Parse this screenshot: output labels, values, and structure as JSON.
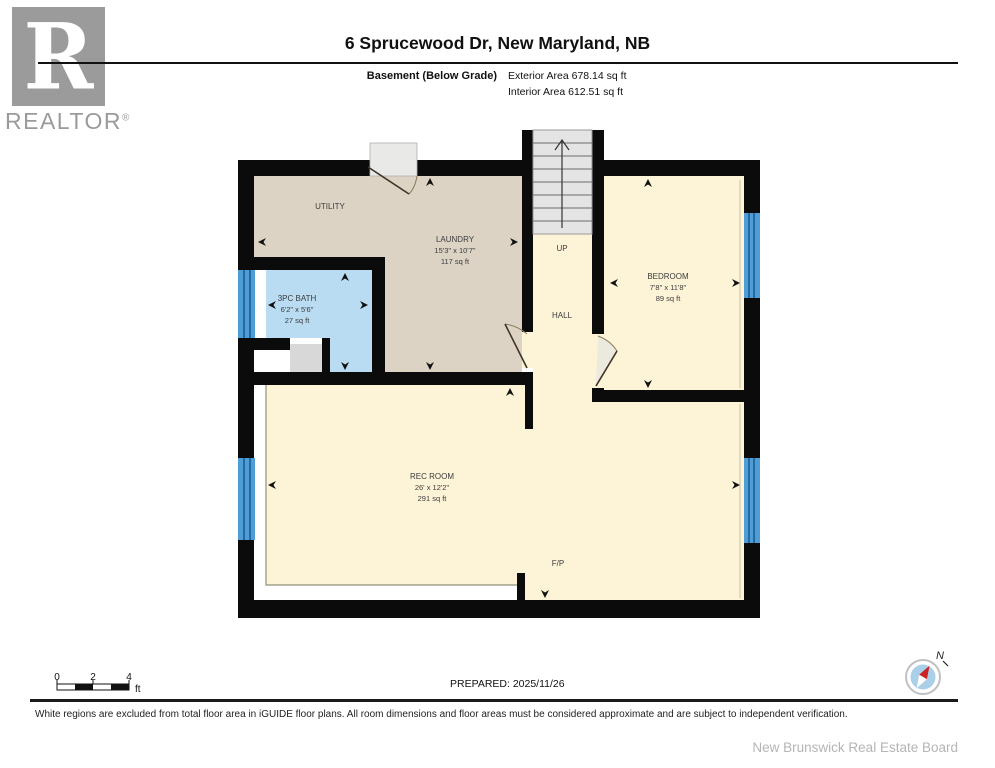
{
  "header": {
    "title": "6 Sprucewood Dr, New Maryland, NB",
    "floor_label": "Basement (Below Grade)",
    "exterior_area": "Exterior Area 678.14 sq ft",
    "interior_area": "Interior Area 612.51 sq ft"
  },
  "logo": {
    "letter": "R",
    "brand": "REALTOR",
    "reg": "®"
  },
  "plan": {
    "rooms": [
      {
        "name": "UTILITY",
        "dims": "",
        "area": ""
      },
      {
        "name": "LAUNDRY",
        "dims": "15'3\" x 10'7\"",
        "area": "117 sq ft"
      },
      {
        "name": "3PC BATH",
        "dims": "6'2\" x 5'6\"",
        "area": "27 sq ft"
      },
      {
        "name": "BEDROOM",
        "dims": "7'8\" x 11'8\"",
        "area": "89 sq ft"
      },
      {
        "name": "REC ROOM",
        "dims": "26' x 12'2\"",
        "area": "291 sq ft"
      }
    ],
    "labels": {
      "up": "UP",
      "hall": "HALL",
      "fireplace": "F/P"
    },
    "colors": {
      "wall": "#0b0b0b",
      "laundry_floor": "#dcd3c4",
      "cream_floor": "#fdf3d7",
      "bath_floor": "#b9dcf2",
      "stairs": "#e4e4e4",
      "window": "#4f9dd6",
      "window_stripe": "#1d5d93",
      "closet_gray": "#d8d8d8"
    }
  },
  "scalebar": {
    "t0": "0",
    "t2": "2",
    "t4": "4",
    "unit": "ft"
  },
  "compass": {
    "north": "N"
  },
  "footer": {
    "prepared": "PREPARED: 2025/11/26",
    "disclaimer": "White regions are excluded from total floor area in iGUIDE floor plans. All room dimensions and floor areas must be considered approximate and are subject to independent verification.",
    "board": "New Brunswick Real Estate Board"
  }
}
